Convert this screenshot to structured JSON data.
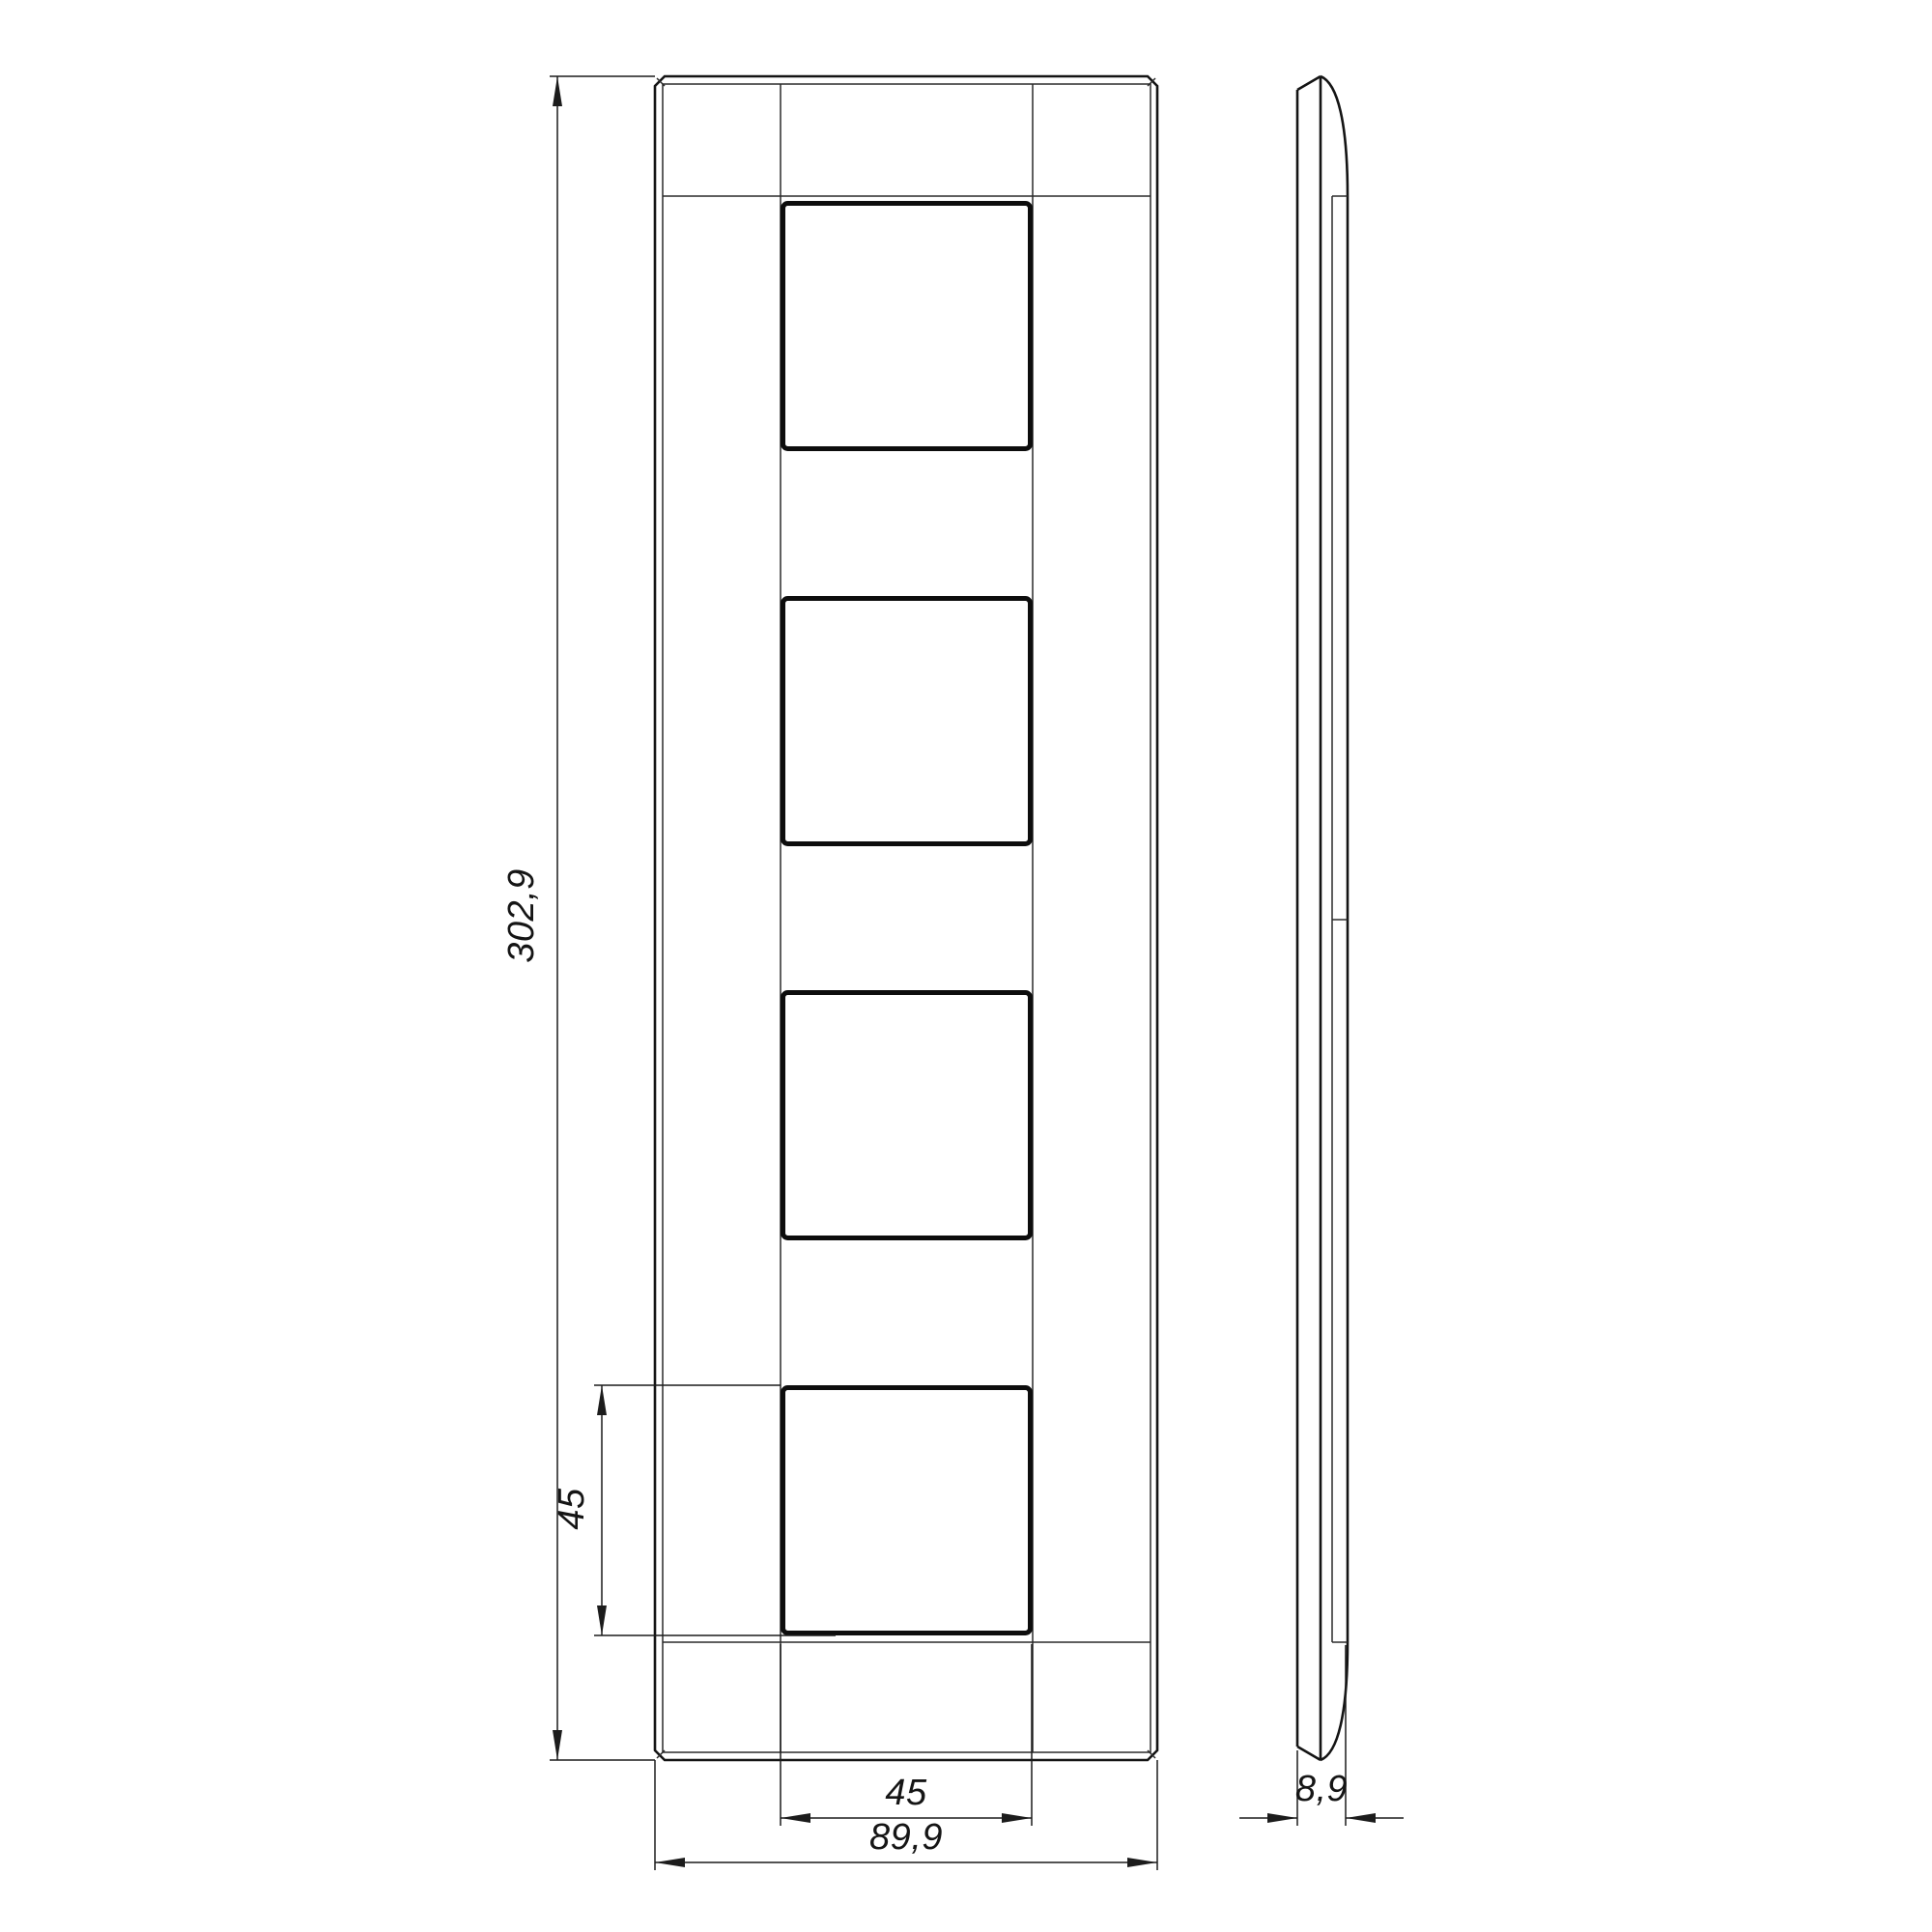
{
  "page": {
    "background": "#ffffff",
    "line_color": "#141414"
  },
  "drawing": {
    "type": "technical-drawing",
    "front_view": {
      "overall_height": "302,9",
      "overall_width": "89,9",
      "window_height": "45",
      "window_width": "45",
      "window_count": 4
    },
    "side_view": {
      "thickness": "8,9"
    }
  }
}
